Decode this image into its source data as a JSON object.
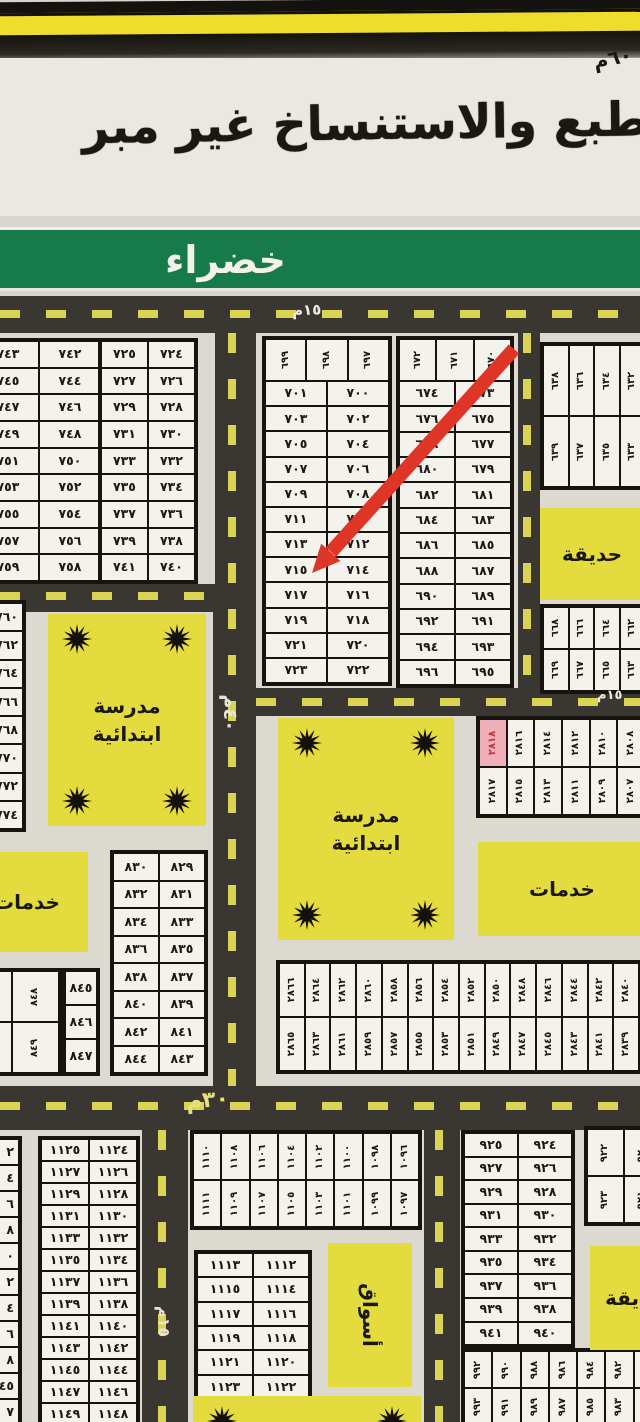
{
  "header": {
    "copy_warning": "الطبع والاستنساخ غير مبر",
    "corner_note": "٦٠م",
    "district_name": "خضراء"
  },
  "map": {
    "highlight_plot": "٢٨١٨",
    "road_labels": {
      "top": "١٥م",
      "middle_right": "١٥م",
      "main_vertical": "٤٠م",
      "bottom_horizontal": "٣٠م",
      "bottom_vertical": "١٥م"
    },
    "areas": [
      {
        "name": "area-garden-top-right",
        "label": "حديقة",
        "x": 540,
        "y": 508,
        "w": 104,
        "h": 92,
        "stars": false
      },
      {
        "name": "area-school-left",
        "label": "مدرسة ابتدائية",
        "x": 48,
        "y": 614,
        "w": 158,
        "h": 212,
        "stars": true
      },
      {
        "name": "area-services-left",
        "label": "خدمات",
        "x": -34,
        "y": 852,
        "w": 122,
        "h": 100,
        "stars": false
      },
      {
        "name": "area-school-middle",
        "label": "مدرسة ابتدائية",
        "x": 278,
        "y": 718,
        "w": 176,
        "h": 222,
        "stars": true
      },
      {
        "name": "area-services-right",
        "label": "خدمات",
        "x": 478,
        "y": 842,
        "w": 168,
        "h": 94,
        "stars": false
      },
      {
        "name": "area-markets",
        "label": "أسواق",
        "x": 328,
        "y": 1243,
        "w": 84,
        "h": 144,
        "stars": false,
        "rot": true
      },
      {
        "name": "area-garden-bottom-right",
        "label": "حديقة",
        "x": 590,
        "y": 1246,
        "w": 90,
        "h": 104,
        "stars": false
      },
      {
        "name": "area-bottom-cut",
        "label": "",
        "x": 193,
        "y": 1396,
        "w": 228,
        "h": 60,
        "stars": true
      }
    ],
    "blocks": [
      {
        "name": "block-742-759",
        "x": -26,
        "y": 338,
        "w": 130,
        "h": 246,
        "sections": [
          {
            "rot": false,
            "rows": [
              [
                "٧٤٣",
                "٧٤٢"
              ],
              [
                "٧٤٥",
                "٧٤٤"
              ],
              [
                "٧٤٧",
                "٧٤٦"
              ],
              [
                "٧٤٩",
                "٧٤٨"
              ],
              [
                "٧٥١",
                "٧٥٠"
              ],
              [
                "٧٥٣",
                "٧٥٢"
              ],
              [
                "٧٥٥",
                "٧٥٤"
              ],
              [
                "٧٥٧",
                "٧٥٦"
              ],
              [
                "٧٥٩",
                "٧٥٨"
              ]
            ]
          }
        ]
      },
      {
        "name": "block-724-741",
        "x": 98,
        "y": 338,
        "w": 100,
        "h": 246,
        "sections": [
          {
            "rot": false,
            "rows": [
              [
                "٧٢٥",
                "٧٢٤"
              ],
              [
                "٧٢٧",
                "٧٢٦"
              ],
              [
                "٧٢٩",
                "٧٢٨"
              ],
              [
                "٧٣١",
                "٧٣٠"
              ],
              [
                "٧٣٣",
                "٧٣٢"
              ],
              [
                "٧٣٥",
                "٧٣٤"
              ],
              [
                "٧٣٧",
                "٧٣٦"
              ],
              [
                "٧٣٩",
                "٧٣٨"
              ],
              [
                "٧٤١",
                "٧٤٠"
              ]
            ]
          }
        ]
      },
      {
        "name": "block-697-723",
        "x": 262,
        "y": 336,
        "w": 130,
        "h": 350,
        "sections": [
          {
            "rot": true,
            "h": 40,
            "rows": [
              [
                "٦٩٩",
                "٦٩٨",
                "٦٩٧"
              ]
            ]
          },
          {
            "rot": false,
            "rows": [
              [
                "٧٠١",
                "٧٠٠"
              ],
              [
                "٧٠٣",
                "٧٠٢"
              ],
              [
                "٧٠٥",
                "٧٠٤"
              ],
              [
                "٧٠٧",
                "٧٠٦"
              ],
              [
                "٧٠٩",
                "٧٠٨"
              ],
              [
                "٧١١",
                "٧١٠"
              ],
              [
                "٧١٣",
                "٧١٢"
              ],
              [
                "٧١٥",
                "٧١٤"
              ],
              [
                "٧١٧",
                "٧١٦"
              ],
              [
                "٧١٩",
                "٧١٨"
              ],
              [
                "٧٢١",
                "٧٢٠"
              ],
              [
                "٧٢٣",
                "٧٢٢"
              ]
            ]
          }
        ]
      },
      {
        "name": "block-670-696",
        "x": 396,
        "y": 336,
        "w": 118,
        "h": 352,
        "sections": [
          {
            "rot": true,
            "h": 40,
            "rows": [
              [
                "٦٧٢",
                "٦٧١",
                "٦٧٠"
              ]
            ]
          },
          {
            "rot": false,
            "rows": [
              [
                "٦٧٤",
                "٦٧٣"
              ],
              [
                "٦٧٦",
                "٦٧٥"
              ],
              [
                "٦٧٨",
                "٦٧٧"
              ],
              [
                "٦٨٠",
                "٦٧٩"
              ],
              [
                "٦٨٢",
                "٦٨١"
              ],
              [
                "٦٨٤",
                "٦٨٣"
              ],
              [
                "٦٨٦",
                "٦٨٥"
              ],
              [
                "٦٨٨",
                "٦٨٧"
              ],
              [
                "٦٩٠",
                "٦٨٩"
              ],
              [
                "٦٩٢",
                "٦٩١"
              ],
              [
                "٦٩٤",
                "٦٩٣"
              ],
              [
                "٦٩٦",
                "٦٩٥"
              ]
            ]
          }
        ]
      },
      {
        "name": "block-632-639",
        "x": 540,
        "y": 342,
        "w": 108,
        "h": 148,
        "sections": [
          {
            "rot": true,
            "rows": [
              [
                "٦٣٨",
                "٦٣٦",
                "٦٣٤",
                "٦٣٢"
              ],
              [
                "٦٣٩",
                "٦٣٧",
                "٦٣٥",
                "٦٣٣"
              ]
            ]
          }
        ]
      },
      {
        "name": "block-662-669",
        "x": 540,
        "y": 604,
        "w": 108,
        "h": 90,
        "sections": [
          {
            "rot": true,
            "rows": [
              [
                "٦٦٨",
                "٦٦٦",
                "٦٦٤",
                "٦٦٢"
              ],
              [
                "٦٦٩",
                "٦٦٧",
                "٦٦٥",
                "٦٦٣"
              ]
            ]
          }
        ]
      },
      {
        "name": "block-760-774",
        "x": -38,
        "y": 600,
        "w": 64,
        "h": 232,
        "frag": true,
        "sections": [
          {
            "rot": false,
            "rows": [
              [
                "٧٦٠"
              ],
              [
                "٧٦٢"
              ],
              [
                "٧٦٤"
              ],
              [
                "٧٦٦"
              ],
              [
                "٧٦٨"
              ],
              [
                "٧٧٠"
              ],
              [
                "٧٧٢"
              ],
              [
                "٧٧٤"
              ]
            ]
          }
        ]
      },
      {
        "name": "block-829-844",
        "x": 110,
        "y": 850,
        "w": 98,
        "h": 226,
        "sections": [
          {
            "rot": false,
            "rows": [
              [
                "٨٣٠",
                "٨٢٩"
              ],
              [
                "٨٣٢",
                "٨٣١"
              ],
              [
                "٨٣٤",
                "٨٣٣"
              ],
              [
                "٨٣٦",
                "٨٣٥"
              ],
              [
                "٨٣٨",
                "٨٣٧"
              ],
              [
                "٨٤٠",
                "٨٣٩"
              ],
              [
                "٨٤٢",
                "٨٤١"
              ],
              [
                "٨٤٤",
                "٨٤٣"
              ]
            ]
          }
        ]
      },
      {
        "name": "block-848-851",
        "x": -38,
        "y": 968,
        "w": 100,
        "h": 108,
        "sections": [
          {
            "rot": true,
            "rows": [
              [
                "٨٥٠",
                "٨٤٨"
              ],
              [
                "٨٥١",
                "٨٤٩"
              ]
            ]
          }
        ]
      },
      {
        "name": "block-845-847",
        "x": 62,
        "y": 968,
        "w": 38,
        "h": 108,
        "sections": [
          {
            "rot": false,
            "rows": [
              [
                "٨٤٥"
              ],
              [
                "٨٤٦"
              ],
              [
                "٨٤٧"
              ]
            ]
          }
        ]
      },
      {
        "name": "block-2807-2818",
        "x": 476,
        "y": 716,
        "w": 172,
        "h": 102,
        "sections": [
          {
            "rot": true,
            "rows": [
              [
                "٢٨١٨",
                "٢٨١٦",
                "٢٨١٤",
                "٢٨١٢",
                "٢٨١٠",
                "٢٨٠٨"
              ],
              [
                "٢٨١٧",
                "٢٨١٥",
                "٢٨١٣",
                "٢٨١١",
                "٢٨٠٩",
                "٢٨٠٧"
              ]
            ]
          }
        ]
      },
      {
        "name": "block-2839-2866",
        "x": 276,
        "y": 960,
        "w": 366,
        "h": 114,
        "sections": [
          {
            "rot": true,
            "rows": [
              [
                "٢٨٦٦",
                "٢٨٦٤",
                "٢٨٦٢",
                "٢٨٦٠",
                "٢٨٥٨",
                "٢٨٥٦",
                "٢٨٥٤",
                "٢٨٥٢",
                "٢٨٥٠",
                "٢٨٤٨",
                "٢٨٤٦",
                "٢٨٤٤",
                "٢٨٤٢",
                "٢٨٤٠"
              ],
              [
                "٢٨٦٥",
                "٢٨٦٣",
                "٢٨٦١",
                "٢٨٥٩",
                "٢٨٥٧",
                "٢٨٥٥",
                "٢٨٥٣",
                "٢٨٥١",
                "٢٨٤٩",
                "٢٨٤٧",
                "٢٨٤٥",
                "٢٨٤٣",
                "٢٨٤١",
                "٢٨٣٩"
              ]
            ]
          }
        ]
      },
      {
        "name": "block-1124-1149",
        "x": 38,
        "y": 1136,
        "w": 102,
        "h": 292,
        "sections": [
          {
            "rot": false,
            "rows": [
              [
                "١١٢٥",
                "١١٢٤"
              ],
              [
                "١١٢٧",
                "١١٢٦"
              ],
              [
                "١١٢٩",
                "١١٢٨"
              ],
              [
                "١١٣١",
                "١١٣٠"
              ],
              [
                "١١٣٣",
                "١١٣٢"
              ],
              [
                "١١٣٥",
                "١١٣٤"
              ],
              [
                "١١٣٧",
                "١١٣٦"
              ],
              [
                "١١٣٩",
                "١١٣٨"
              ],
              [
                "١١٤١",
                "١١٤٠"
              ],
              [
                "١١٤٣",
                "١١٤٢"
              ],
              [
                "١١٤٥",
                "١١٤٤"
              ],
              [
                "١١٤٧",
                "١١٤٦"
              ],
              [
                "١١٤٩",
                "١١٤٨"
              ]
            ]
          }
        ]
      },
      {
        "name": "block-left-edge-fragments",
        "x": -36,
        "y": 1136,
        "w": 58,
        "h": 292,
        "frag": true,
        "sections": [
          {
            "rot": false,
            "rows": [
              [
                "٢"
              ],
              [
                "٤"
              ],
              [
                "٦"
              ],
              [
                "٨"
              ],
              [
                "٠"
              ],
              [
                "٢"
              ],
              [
                "٤"
              ],
              [
                "٦"
              ],
              [
                "٨"
              ],
              [
                "٤٥"
              ],
              [
                "٧"
              ]
            ]
          }
        ]
      },
      {
        "name": "block-1096-1111",
        "x": 190,
        "y": 1130,
        "w": 232,
        "h": 100,
        "sections": [
          {
            "rot": true,
            "rows": [
              [
                "١١١٠",
                "١١٠٨",
                "١١٠٦",
                "١١٠٤",
                "١١٠٢",
                "١١٠٠",
                "١٠٩٨",
                "١٠٩٦"
              ],
              [
                "١١١١",
                "١١٠٩",
                "١١٠٧",
                "١١٠٥",
                "١١٠٣",
                "١١٠١",
                "١٠٩٩",
                "١٠٩٧"
              ]
            ]
          }
        ]
      },
      {
        "name": "block-1112-1123",
        "x": 194,
        "y": 1250,
        "w": 118,
        "h": 152,
        "sections": [
          {
            "rot": false,
            "rows": [
              [
                "١١١٣",
                "١١١٢"
              ],
              [
                "١١١٥",
                "١١١٤"
              ],
              [
                "١١١٧",
                "١١١٦"
              ],
              [
                "١١١٩",
                "١١١٨"
              ],
              [
                "١١٢١",
                "١١٢٠"
              ],
              [
                "١١٢٣",
                "١١٢٢"
              ]
            ]
          }
        ]
      },
      {
        "name": "block-924-941",
        "x": 461,
        "y": 1130,
        "w": 114,
        "h": 218,
        "sections": [
          {
            "rot": false,
            "rows": [
              [
                "٩٢٥",
                "٩٢٤"
              ],
              [
                "٩٢٧",
                "٩٢٦"
              ],
              [
                "٩٢٩",
                "٩٢٨"
              ],
              [
                "٩٣١",
                "٩٣٠"
              ],
              [
                "٩٣٣",
                "٩٣٢"
              ],
              [
                "٩٣٥",
                "٩٣٤"
              ],
              [
                "٩٣٧",
                "٩٣٦"
              ],
              [
                "٩٣٩",
                "٩٣٨"
              ],
              [
                "٩٤١",
                "٩٤٠"
              ]
            ]
          }
        ]
      },
      {
        "name": "block-920-923",
        "x": 584,
        "y": 1126,
        "w": 80,
        "h": 100,
        "sections": [
          {
            "rot": true,
            "rows": [
              [
                "٩٢٢",
                "٩٢٠"
              ],
              [
                "٩٢٣",
                "٩٢١"
              ]
            ]
          }
        ]
      },
      {
        "name": "block-980-993",
        "x": 461,
        "y": 1348,
        "w": 204,
        "h": 80,
        "sections": [
          {
            "rot": true,
            "rows": [
              [
                "٩٩٢",
                "٩٩٠",
                "٩٨٨",
                "٩٨٦",
                "٩٨٤",
                "٩٨٢",
                "٩٨٠"
              ],
              [
                "٩٩٣",
                "٩٩١",
                "٩٨٩",
                "٩٨٧",
                "٩٨٥",
                "٩٨٣",
                "٩٨١"
              ]
            ]
          }
        ]
      }
    ]
  }
}
